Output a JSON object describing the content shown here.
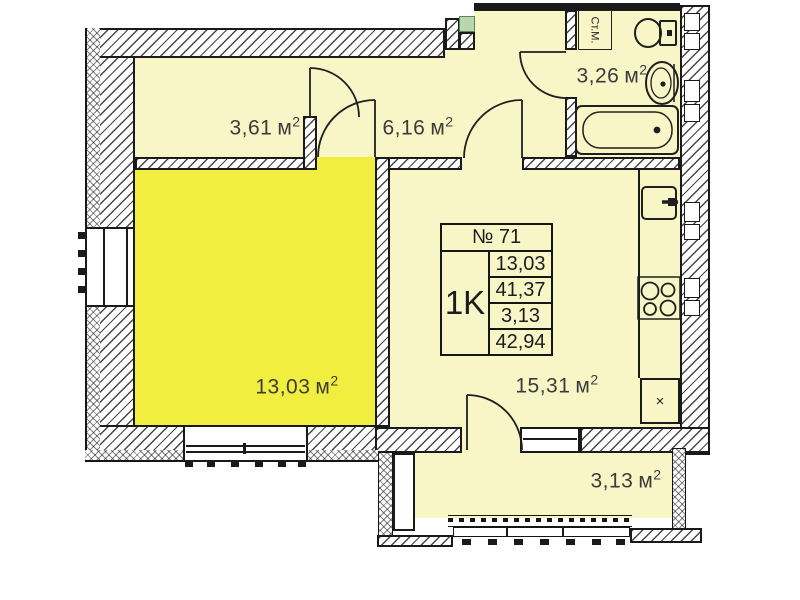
{
  "palette": {
    "room_pale": "#f8f6c6",
    "room_bright": "#f2ee40",
    "line": "#1a1a1a",
    "entry_marker": "#b9d7ad"
  },
  "units": {
    "base": "м",
    "sup": "2"
  },
  "rooms": {
    "top_left": {
      "area": "3,61"
    },
    "hallway": {
      "area": "6,16"
    },
    "bathroom": {
      "area": "3,26"
    },
    "living": {
      "area": "13,03"
    },
    "kitchen": {
      "area": "15,31"
    },
    "balcony": {
      "area": "3,13"
    }
  },
  "bathroom": {
    "washing_machine_label": "Ст.М."
  },
  "kitchen": {
    "vent_mark": "×"
  },
  "info_table": {
    "number": "№ 71",
    "apartment_type": "1K",
    "rows": [
      "13,03",
      "41,37",
      "3,13",
      "42,94"
    ]
  }
}
